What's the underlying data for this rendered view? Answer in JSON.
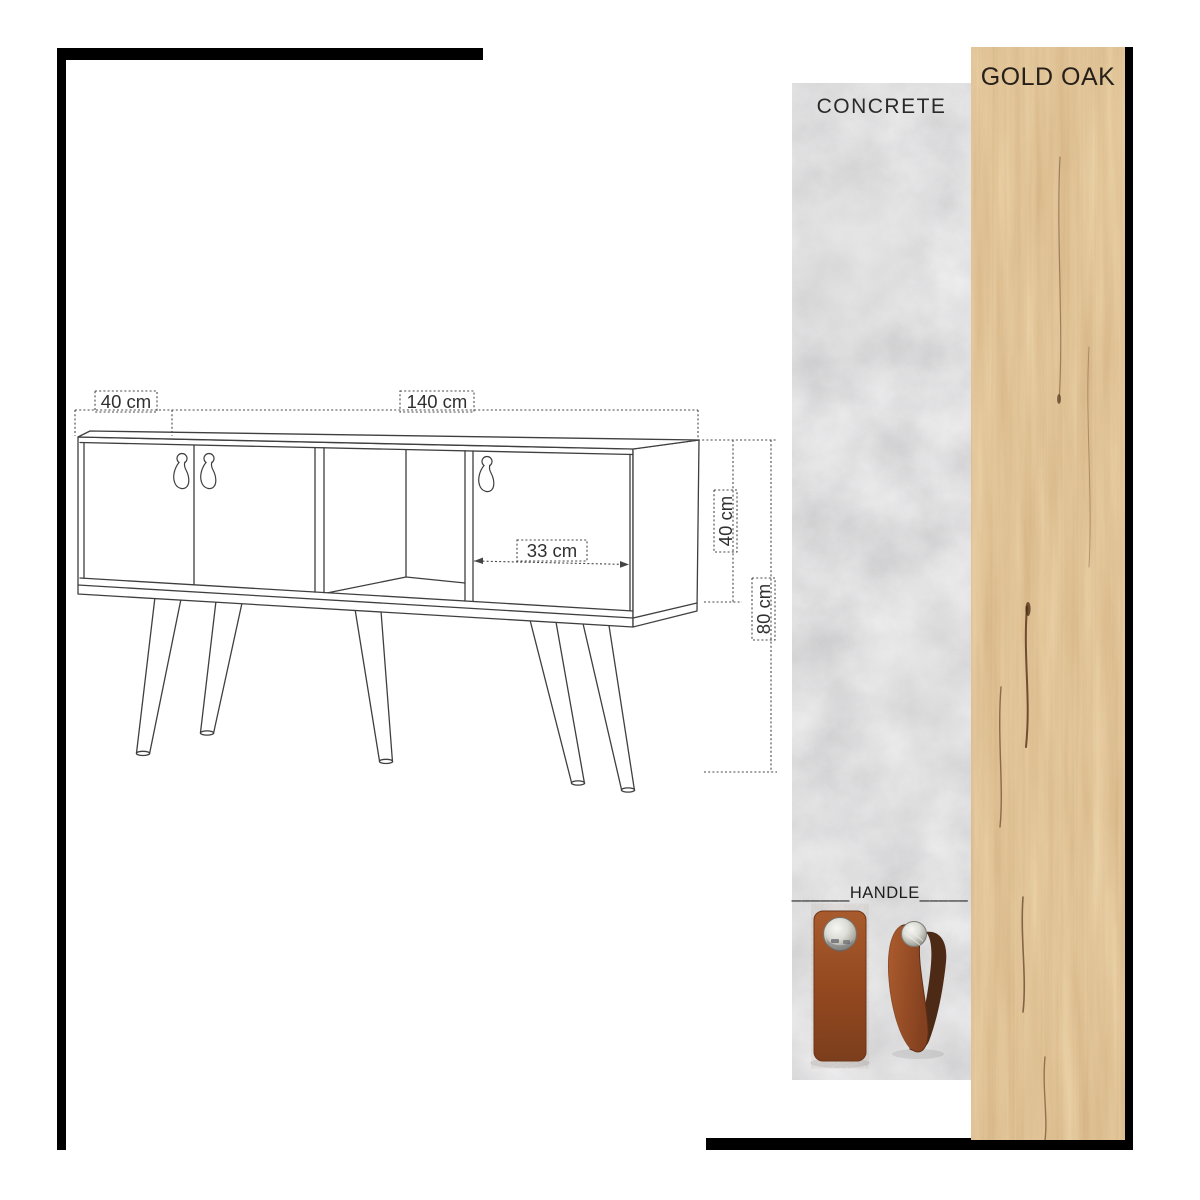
{
  "sheet": {
    "background": "#ffffff",
    "frame_color": "#000000"
  },
  "materials": [
    {
      "name": "CONCRETE",
      "swatch_color": "#b5b5b5"
    },
    {
      "name": "GOLD OAK",
      "swatch_color": "#c68c4e"
    }
  ],
  "handle": {
    "label": "______HANDLE_____",
    "leather_color": "#9a5128",
    "metal_color": "#d8d8d3"
  },
  "diagram": {
    "line_color": "#3f3f3f",
    "dimensions": {
      "left_door_width": "40 cm",
      "total_width": "140 cm",
      "right_door_width": "33 cm",
      "body_height": "40 cm",
      "total_height": "80 cm"
    }
  }
}
